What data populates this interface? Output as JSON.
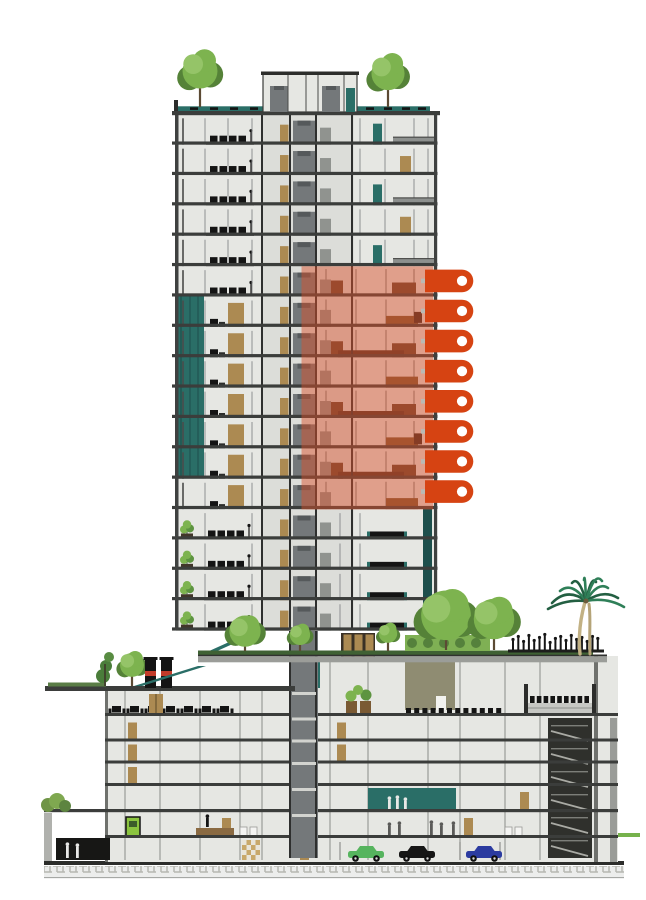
{
  "scene": {
    "type": "architectural-section-drawing",
    "title": "High-rise residential tower cross-section with eight highlighted floors",
    "canvas": {
      "width": 646,
      "height": 900,
      "background": "#ffffff"
    }
  },
  "colors": {
    "background": "#ffffff",
    "slab": "#3b3d3b",
    "wall_light": "#e6e7e3",
    "core_gray": "#74787a",
    "teal": "#2a6e67",
    "teal_dark": "#1d4f4c",
    "tan": "#ac8a52",
    "brown": "#7c5633",
    "dark_brown": "#64432f",
    "khaki": "#8f8c72",
    "tree_green": "#7db34f",
    "tree_dark": "#558238",
    "palm_green": "#2f7f58",
    "palm_dark": "#235f42",
    "palm_trunk": "#c2b184",
    "accent_green": "#8bc43f",
    "accent_red": "#c23b2a",
    "highlight_fill": "#d9512b",
    "tag_color": "#d64312",
    "tag_dot": "#ffffff"
  },
  "tower": {
    "floors_total": 17,
    "floor_types": [
      "upper",
      "upper",
      "upper",
      "upper",
      "upper",
      "highlight",
      "highlight",
      "highlight",
      "highlight",
      "highlight",
      "highlight",
      "highlight",
      "highlight",
      "garden",
      "garden",
      "garden",
      "garden"
    ],
    "roof_trees": 2,
    "balcony_plant_floors": 4,
    "teal_curtain_wall_floors": 6
  },
  "highlight": {
    "floor_count": 8,
    "first_floor_index": 5,
    "opacity": 0.48,
    "zone": "right residential bay"
  },
  "tags": {
    "count": 8,
    "shape": "rounded-pin-with-dot",
    "items": [
      {
        "index": 1
      },
      {
        "index": 2
      },
      {
        "index": 3
      },
      {
        "index": 4
      },
      {
        "index": 5
      },
      {
        "index": 6
      },
      {
        "index": 7
      },
      {
        "index": 8
      }
    ]
  },
  "podium": {
    "levels": 7,
    "features": [
      "roof-garden",
      "palm-tree",
      "tree-canopies",
      "crowd-silhouettes",
      "auditorium",
      "theater-seating",
      "restaurant-terrace",
      "teal-lobby",
      "stair-shaft",
      "parking-basement"
    ]
  },
  "terrace": {
    "trees": 5,
    "hedge": 1,
    "palm_trees": 1,
    "people_cluster": 1
  },
  "annex": {
    "roof_trees": 2,
    "chimneys": 2,
    "ramp_segments": 2
  },
  "ground": {
    "cars": [
      {
        "name": "car-green",
        "color": "#56b45e"
      },
      {
        "name": "car-black",
        "color": "#161616"
      },
      {
        "name": "car-blue",
        "color": "#2b3ba0"
      }
    ],
    "people_groups": 3,
    "hatch_band": true
  }
}
